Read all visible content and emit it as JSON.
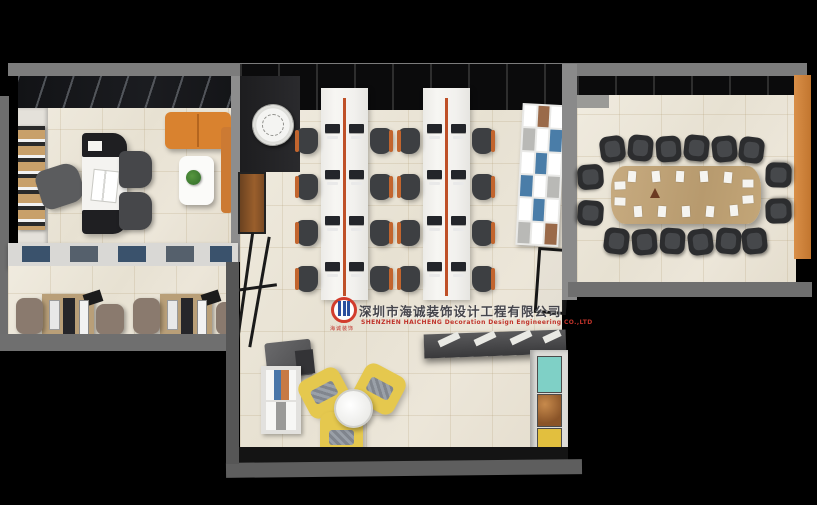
{
  "scene": {
    "type": "3D top-down rendering of an office interior",
    "areas": [
      "manager-office",
      "staff-workstation-room",
      "open-office-area",
      "lounge-reception",
      "conference-room"
    ],
    "open_office_seats": 16,
    "conference_seats": 16,
    "lounge_armchairs": 3
  },
  "watermark": {
    "company_name_zh": "深圳市海诚装饰设计工程有限公司",
    "company_name_en": "SHENZHEN HAICHENG Decoration Design Engineering CO.,LTD",
    "logo_caption": "海诚装饰"
  },
  "palette": {
    "background": "#000000",
    "wall_gray": "#7c7c7c",
    "floor_beige": "#eae4d7",
    "desk_white": "#f2f1ee",
    "cable_tray_orange": "#bf5028",
    "chair_dark": "#3d3f42",
    "chair_accent_orange": "#c2652e",
    "sofa_orange": "#d9822f",
    "armchair_yellow": "#e5c84e",
    "conference_table_wood": "#bfa379",
    "workstation_wood": "#b99f78",
    "panel_teal": "#7fd0c6",
    "panel_yellow": "#e2bf3e",
    "accent_wall_orange": "#d08440",
    "logo_red": "#d23c2c",
    "logo_blue": "#2b4f9e"
  }
}
